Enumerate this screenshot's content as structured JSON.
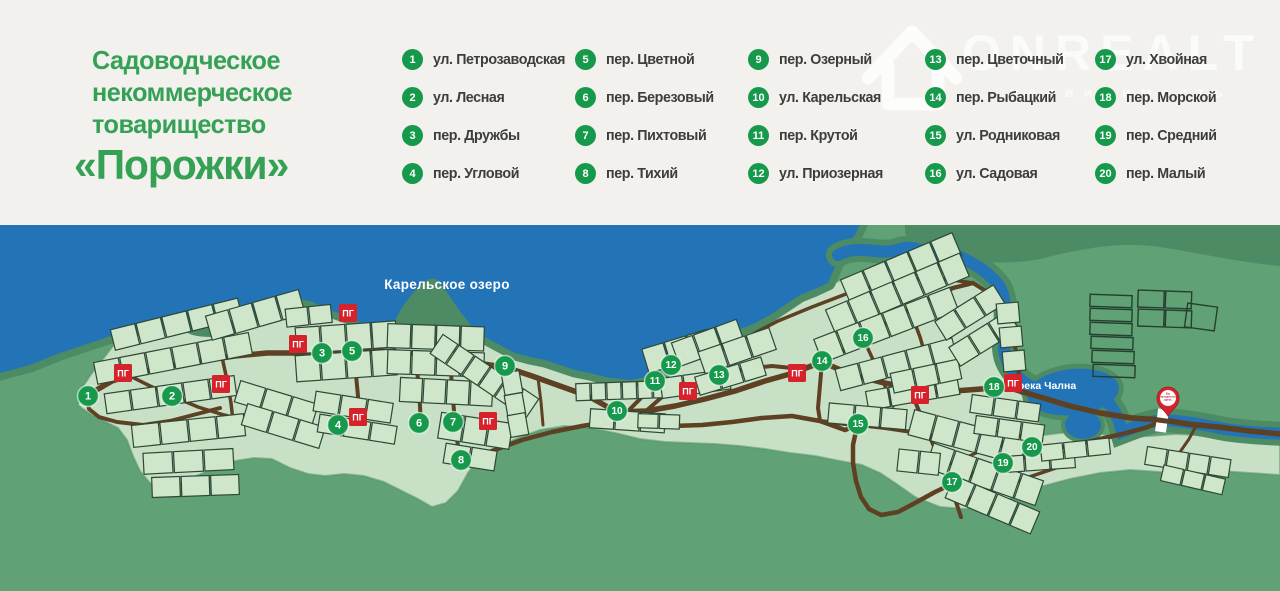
{
  "title": {
    "line1": "Садоводческое",
    "line2": "некоммерческое",
    "line3": "товарищество",
    "line4": "«Порожки»"
  },
  "watermark": {
    "brand": "ONREALT",
    "tagline": "недвижимость"
  },
  "legend": {
    "items": [
      {
        "n": "1",
        "label": "ул. Петрозаводская"
      },
      {
        "n": "2",
        "label": "ул. Лесная"
      },
      {
        "n": "3",
        "label": "пер. Дружбы"
      },
      {
        "n": "4",
        "label": "пер. Угловой"
      },
      {
        "n": "5",
        "label": "пер. Цветной"
      },
      {
        "n": "6",
        "label": "пер. Березовый"
      },
      {
        "n": "7",
        "label": "пер. Пихтовый"
      },
      {
        "n": "8",
        "label": "пер. Тихий"
      },
      {
        "n": "9",
        "label": "пер. Озерный"
      },
      {
        "n": "10",
        "label": "ул. Карельская"
      },
      {
        "n": "11",
        "label": "пер. Крутой"
      },
      {
        "n": "12",
        "label": "ул. Приозерная"
      },
      {
        "n": "13",
        "label": "пер. Цветочный"
      },
      {
        "n": "14",
        "label": "пер. Рыбацкий"
      },
      {
        "n": "15",
        "label": "ул. Родниковая"
      },
      {
        "n": "16",
        "label": "ул. Садовая"
      },
      {
        "n": "17",
        "label": "ул. Хвойная"
      },
      {
        "n": "18",
        "label": "пер. Морской"
      },
      {
        "n": "19",
        "label": "пер. Средний"
      },
      {
        "n": "20",
        "label": "пер. Малый"
      }
    ]
  },
  "map": {
    "lake_label": "Карельское озеро",
    "river_label": "река Чална",
    "hydrant_label": "ПГ",
    "pin_lines": [
      "Вы",
      "находитесь",
      "здесь"
    ],
    "markers": [
      {
        "n": "1",
        "x": 88,
        "y": 171
      },
      {
        "n": "2",
        "x": 172,
        "y": 171
      },
      {
        "n": "3",
        "x": 322,
        "y": 128
      },
      {
        "n": "4",
        "x": 338,
        "y": 200
      },
      {
        "n": "5",
        "x": 352,
        "y": 126
      },
      {
        "n": "6",
        "x": 419,
        "y": 198
      },
      {
        "n": "7",
        "x": 453,
        "y": 197
      },
      {
        "n": "8",
        "x": 461,
        "y": 235
      },
      {
        "n": "9",
        "x": 505,
        "y": 141
      },
      {
        "n": "10",
        "x": 617,
        "y": 186
      },
      {
        "n": "11",
        "x": 655,
        "y": 156
      },
      {
        "n": "12",
        "x": 671,
        "y": 140
      },
      {
        "n": "13",
        "x": 719,
        "y": 150
      },
      {
        "n": "14",
        "x": 822,
        "y": 136
      },
      {
        "n": "15",
        "x": 858,
        "y": 199
      },
      {
        "n": "16",
        "x": 863,
        "y": 113
      },
      {
        "n": "17",
        "x": 952,
        "y": 257
      },
      {
        "n": "18",
        "x": 994,
        "y": 162
      },
      {
        "n": "19",
        "x": 1003,
        "y": 238
      },
      {
        "n": "20",
        "x": 1032,
        "y": 222
      }
    ],
    "hydrants": [
      [
        123,
        148
      ],
      [
        221,
        159
      ],
      [
        298,
        119
      ],
      [
        348,
        88
      ],
      [
        358,
        192
      ],
      [
        488,
        196
      ],
      [
        688,
        166
      ],
      [
        797,
        148
      ],
      [
        920,
        170
      ],
      [
        1013,
        158
      ]
    ]
  },
  "colors": {
    "title_green": "#35a155",
    "legend_circle_green": "#17994c",
    "water_blue": "#2373b7",
    "land_green": "#61a176",
    "forest_green": "#4d8b64",
    "settlement_green": "#c8e0c5",
    "road_brown": "#5e4023",
    "hydrant_red": "#d6232b",
    "pin_red": "#d6232b"
  }
}
